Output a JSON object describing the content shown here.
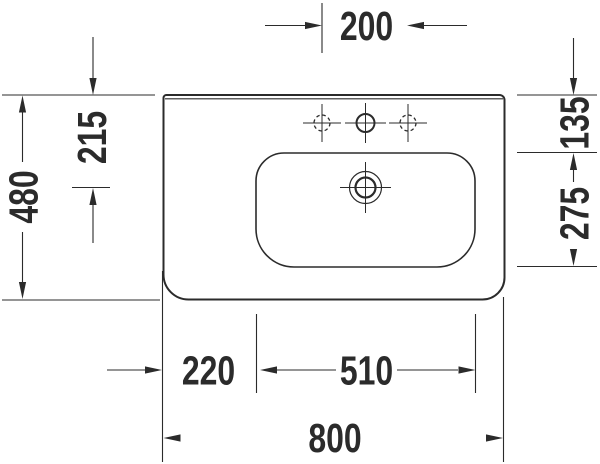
{
  "style": {
    "ink": "#2b2b2b",
    "background": "#ffffff"
  },
  "dims": {
    "tap_spacing": "200",
    "overall_depth": "480",
    "rim_to_drain": "215",
    "rim_to_bowl": "135",
    "bowl_depth": "275",
    "left_offset": "220",
    "bowl_width": "510",
    "overall_width": "800"
  }
}
